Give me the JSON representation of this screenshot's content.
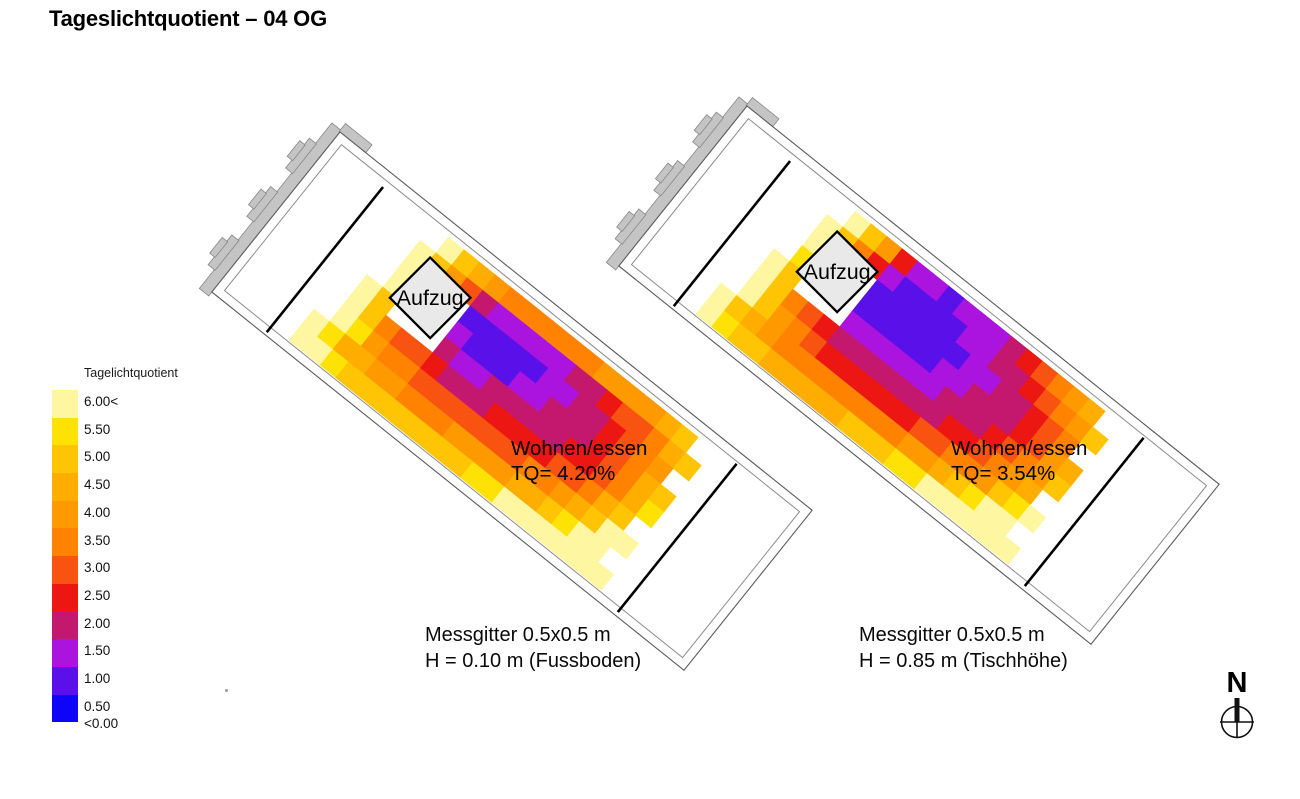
{
  "page_title": "Tageslichtquotient – 04 OG",
  "north_label": "N",
  "chart_data": {
    "type": "heatmap",
    "title": "Tageslichtquotient – 04 OG",
    "grid_note": "Messgitter 0.5x0.5 m",
    "legend": {
      "title": "Tagelichtquotient",
      "top_swatch_color": "#ffffff",
      "classes": [
        {
          "label": "6.00<",
          "color": "#fff6a2"
        },
        {
          "label": "5.50",
          "color": "#ffe205"
        },
        {
          "label": "5.00",
          "color": "#ffc403"
        },
        {
          "label": "4.50",
          "color": "#ffad00"
        },
        {
          "label": "4.00",
          "color": "#ff9900"
        },
        {
          "label": "3.50",
          "color": "#ff8300"
        },
        {
          "label": "3.00",
          "color": "#f85310"
        },
        {
          "label": "2.50",
          "color": "#ec1713"
        },
        {
          "label": "2.00",
          "color": "#c4176e"
        },
        {
          "label": "1.50",
          "color": "#ab14df"
        },
        {
          "label": "1.00",
          "color": "#5a10e8"
        },
        {
          "label": "0.50",
          "color": "#0e04f8"
        }
      ],
      "below_scale_label": "<0.00"
    },
    "scale_thresholds": [
      6.0,
      5.5,
      5.0,
      4.5,
      4.0,
      3.5,
      3.0,
      2.5,
      2.0,
      1.5,
      1.0
    ],
    "plans": [
      {
        "aufzug": "Aufzug",
        "room": "Wohnen/essen",
        "tq_label": "TQ= 4.20%",
        "tq_percent": 4.2,
        "caption": [
          "Messgitter 0.5x0.5 m",
          "H = 0.10 m (Fussboden)"
        ],
        "grid_values_tq_percent": [
          [
            null,
            null,
            null,
            null,
            6.2,
            5.4,
            4.6,
            4.0,
            3.8,
            3.8,
            3.8,
            3.8,
            3.9,
            3.9,
            4.0,
            4.0,
            4.1,
            4.3,
            4.6,
            5.0,
            null
          ],
          [
            null,
            null,
            null,
            6.1,
            5.2,
            4.2,
            3.3,
            2.2,
            1.8,
            1.5,
            1.5,
            1.6,
            1.8,
            2.1,
            2.4,
            2.7,
            3.0,
            3.4,
            3.9,
            4.5,
            5.3
          ],
          [
            null,
            null,
            null,
            6.2,
            null,
            null,
            null,
            1.4,
            1.2,
            1.1,
            1.2,
            1.4,
            1.6,
            1.9,
            2.2,
            2.4,
            2.7,
            3.1,
            3.6,
            4.2,
            null
          ],
          [
            null,
            null,
            null,
            6.0,
            null,
            null,
            null,
            1.6,
            1.4,
            1.3,
            1.4,
            1.6,
            1.8,
            2.0,
            2.2,
            2.4,
            2.7,
            3.2,
            3.8,
            4.5,
            5.2
          ],
          [
            null,
            null,
            6.2,
            5.1,
            null,
            null,
            null,
            2.0,
            1.9,
            1.9,
            2.0,
            2.0,
            2.1,
            2.2,
            2.3,
            2.5,
            2.8,
            3.3,
            3.9,
            4.6,
            5.5
          ],
          [
            null,
            null,
            6.1,
            5.2,
            3.9,
            3.3,
            3.0,
            2.6,
            2.4,
            2.4,
            2.4,
            2.5,
            2.5,
            2.6,
            2.8,
            3.0,
            3.4,
            3.9,
            4.5,
            5.3,
            null
          ],
          [
            null,
            null,
            6.2,
            5.5,
            4.4,
            3.8,
            3.5,
            3.2,
            3.1,
            3.0,
            3.1,
            3.1,
            3.2,
            3.3,
            3.5,
            3.8,
            4.2,
            4.7,
            5.4,
            6.1,
            6.4
          ],
          [
            null,
            6.3,
            5.6,
            4.9,
            4.5,
            4.2,
            4.0,
            3.9,
            3.9,
            3.9,
            4.0,
            4.1,
            4.2,
            4.4,
            4.6,
            4.9,
            5.3,
            5.8,
            6.2,
            6.5,
            null
          ],
          [
            null,
            6.4,
            6.0,
            5.6,
            5.4,
            5.2,
            5.1,
            5.1,
            5.1,
            5.2,
            5.3,
            5.4,
            5.6,
            5.8,
            6.0,
            6.2,
            6.4,
            6.5,
            6.5,
            6.5,
            6.5
          ]
        ]
      },
      {
        "aufzug": "Aufzug",
        "room": "Wohnen/essen",
        "tq_label": "TQ= 3.54%",
        "tq_percent": 3.54,
        "caption": [
          "Messgitter 0.5x0.5 m",
          "H = 0.85 m (Tischhöhe)"
        ],
        "grid_values_tq_percent": [
          [
            null,
            null,
            null,
            null,
            6.1,
            5.2,
            4.3,
            2.6,
            1.7,
            1.5,
            1.4,
            1.5,
            1.6,
            1.8,
            2.1,
            2.5,
            3.0,
            3.6,
            4.2,
            4.8,
            null
          ],
          [
            null,
            null,
            null,
            6.0,
            5.0,
            3.9,
            2.8,
            1.7,
            1.4,
            1.2,
            1.2,
            1.3,
            1.5,
            1.7,
            2.0,
            2.3,
            2.7,
            3.2,
            3.8,
            4.4,
            5.1
          ],
          [
            null,
            null,
            null,
            6.1,
            null,
            null,
            null,
            1.2,
            1.1,
            1.0,
            1.0,
            1.2,
            1.4,
            1.6,
            1.9,
            2.1,
            2.4,
            2.8,
            3.2,
            3.8,
            null
          ],
          [
            null,
            null,
            null,
            5.9,
            null,
            null,
            null,
            1.4,
            1.2,
            1.1,
            1.2,
            1.4,
            1.6,
            1.8,
            2.0,
            2.2,
            2.4,
            2.9,
            3.4,
            4.1,
            4.8
          ],
          [
            null,
            null,
            6.1,
            5.0,
            null,
            null,
            null,
            1.8,
            1.6,
            1.6,
            1.7,
            1.8,
            1.9,
            2.0,
            2.1,
            2.3,
            2.5,
            3.0,
            3.5,
            4.2,
            5.1
          ],
          [
            null,
            null,
            6.0,
            5.0,
            3.6,
            3.0,
            2.7,
            2.3,
            2.1,
            2.1,
            2.1,
            2.2,
            2.3,
            2.4,
            2.5,
            2.8,
            3.1,
            3.6,
            4.2,
            4.9,
            null
          ],
          [
            null,
            null,
            6.1,
            5.3,
            4.1,
            3.5,
            3.2,
            2.9,
            2.8,
            2.7,
            2.8,
            2.9,
            2.9,
            3.0,
            3.2,
            3.5,
            3.9,
            4.4,
            5.0,
            5.7,
            6.2
          ],
          [
            null,
            6.2,
            5.4,
            4.6,
            4.2,
            3.9,
            3.7,
            3.6,
            3.5,
            3.6,
            3.7,
            3.8,
            3.9,
            4.1,
            4.3,
            4.6,
            5.0,
            5.5,
            6.0,
            6.4,
            null
          ],
          [
            null,
            6.3,
            5.8,
            5.3,
            5.1,
            4.9,
            4.8,
            4.7,
            4.8,
            4.9,
            5.0,
            5.1,
            5.3,
            5.5,
            5.7,
            6.0,
            6.2,
            6.4,
            6.5,
            6.5,
            6.5
          ]
        ]
      }
    ]
  }
}
